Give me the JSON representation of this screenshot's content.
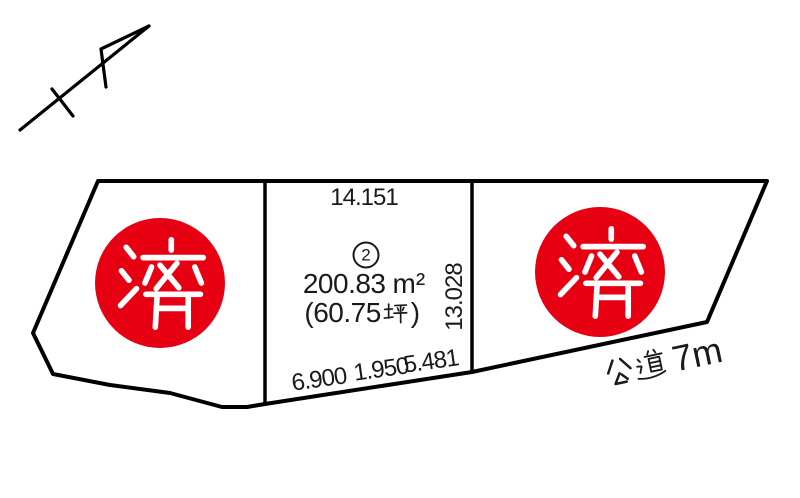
{
  "colors": {
    "stamp_red": "#e60012",
    "line": "#000000",
    "text": "#1a1a1a",
    "background": "#ffffff"
  },
  "north_arrow": {
    "icon": "north-arrow-icon"
  },
  "plots": {
    "left": {
      "stamp": "済"
    },
    "center": {
      "number_circled": "②",
      "number": "2",
      "area_m2": "200.83 ㎡",
      "area_value": "200.83",
      "area_unit": "m²",
      "area_tsubo_full": "（60.75 坪）",
      "area_tsubo_prefix": "(60.75",
      "area_tsubo_unit": "坪",
      "area_tsubo_suffix": ")",
      "dim_top": "14.151",
      "dim_right": "13.028",
      "dim_bottom": [
        "6.900",
        "1.950",
        "5.481"
      ]
    },
    "right": {
      "stamp": "済"
    }
  },
  "road": {
    "label_full": "公道 7m",
    "label_kanji": "公道",
    "label_suffix": "7m"
  }
}
